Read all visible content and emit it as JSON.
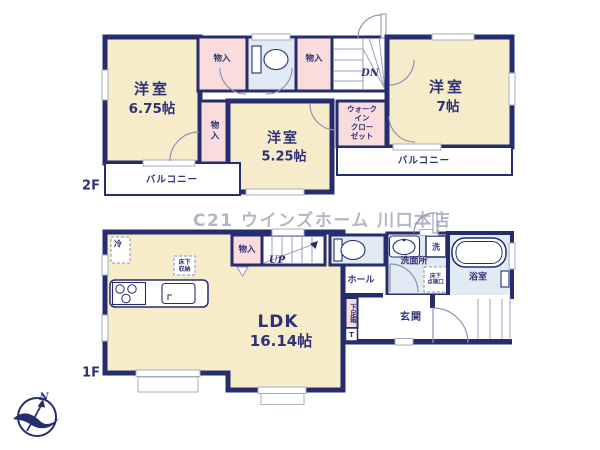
{
  "watermark": "C21 ウインズホーム 川口本店",
  "compass": {
    "north": "N"
  },
  "floor2": {
    "label": "2F",
    "bedroom_675": {
      "name": "洋室",
      "size": "6.75帖"
    },
    "bedroom_525": {
      "name": "洋室",
      "size": "5.25帖"
    },
    "bedroom_7": {
      "name": "洋室",
      "size": "7帖"
    },
    "walk_in_closet": {
      "line1": "ウォーク",
      "line2": "イン",
      "line3": "クロー",
      "line4": "ゼット"
    },
    "closet_a": "物入",
    "closet_b": "物入",
    "closet_c": "物入",
    "balcony_left": "バルコニー",
    "balcony_right": "バルコニー",
    "stairs_down": "DN"
  },
  "floor1": {
    "label": "1F",
    "ldk": {
      "name": "LDK",
      "size": "16.14帖"
    },
    "closet": "物入",
    "stairs_up": "UP",
    "fridge": "冷",
    "underfloor_storage": {
      "line1": "床下",
      "line2": "収納"
    },
    "hall": "ホール",
    "washroom": "洗面所",
    "washer": "洗",
    "underfloor_hatch": {
      "line1": "床下",
      "line2": "点検口"
    },
    "bathroom": "浴室",
    "entrance": "玄関",
    "shoe_box": "下足箱",
    "shoe_box_mark": "T"
  }
}
